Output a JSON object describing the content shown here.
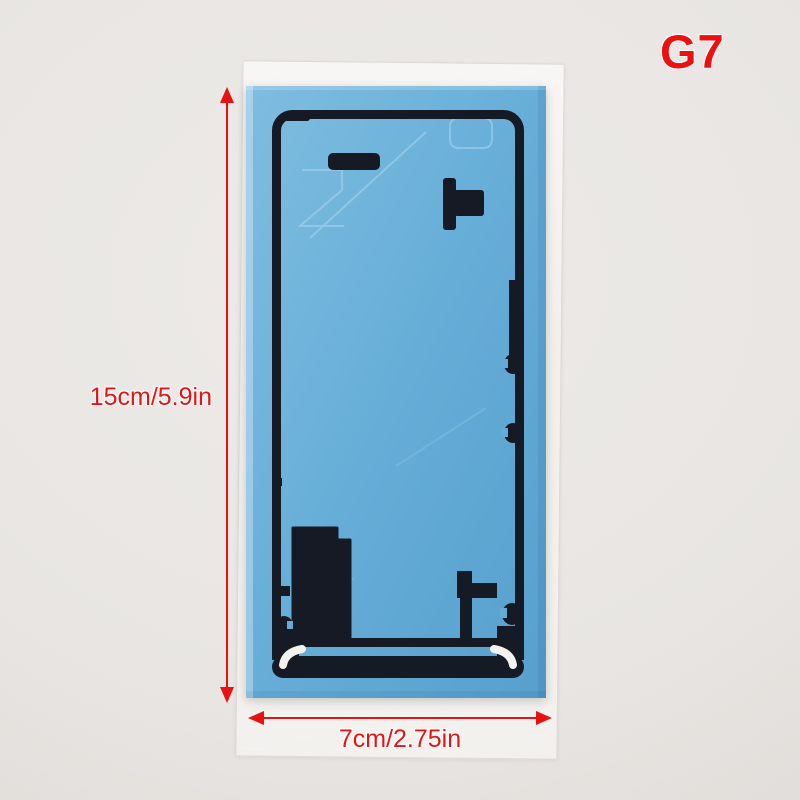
{
  "labels": {
    "model": "G7",
    "height": "15cm/5.9in",
    "width": "7cm/2.75in"
  },
  "colors": {
    "accent_red": "#e81212",
    "sticker_blue": "#63abd6",
    "adhesive_dark": "#151a24",
    "liner_highlight_white": "#f4f2ef",
    "background_gray": "#e8e5e2"
  }
}
